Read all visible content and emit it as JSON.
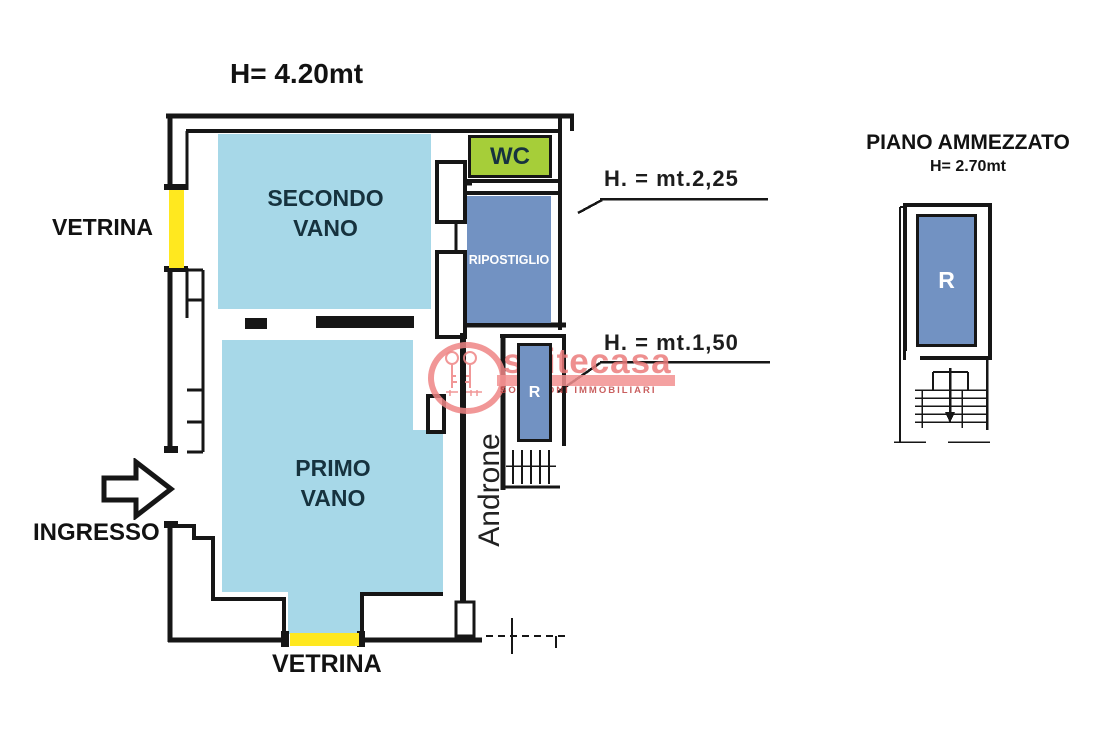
{
  "main_plan": {
    "ceiling_height": "H= 4.20mt",
    "vetrina_left": "VETRINA",
    "vetrina_bottom": "VETRINA",
    "ingresso": "INGRESSO",
    "secondo_vano": {
      "line1": "SECONDO",
      "line2": "VANO"
    },
    "primo_vano": {
      "line1": "PRIMO",
      "line2": "VANO"
    },
    "wc": "WC",
    "ripostiglio": "RIPOSTIGLIO",
    "r": "R",
    "androne": "Androne",
    "height_annotation_upper": "H. = mt.2,25",
    "height_annotation_lower": "H. = mt.1,50"
  },
  "mezzanine_plan": {
    "title": "PIANO AMMEZZATO",
    "height": "H= 2.70mt",
    "r": "R"
  },
  "watermark": {
    "brand": "suitecasa",
    "tagline": "SOLUZIONI IMMOBILIARI"
  },
  "colors": {
    "room_fill": "#a7d8e8",
    "storage_fill": "#7292c2",
    "wc_fill": "#a6ce39",
    "vetrina_fill": "#ffe81f",
    "wall": "#161616",
    "watermark": "#ef8585"
  }
}
